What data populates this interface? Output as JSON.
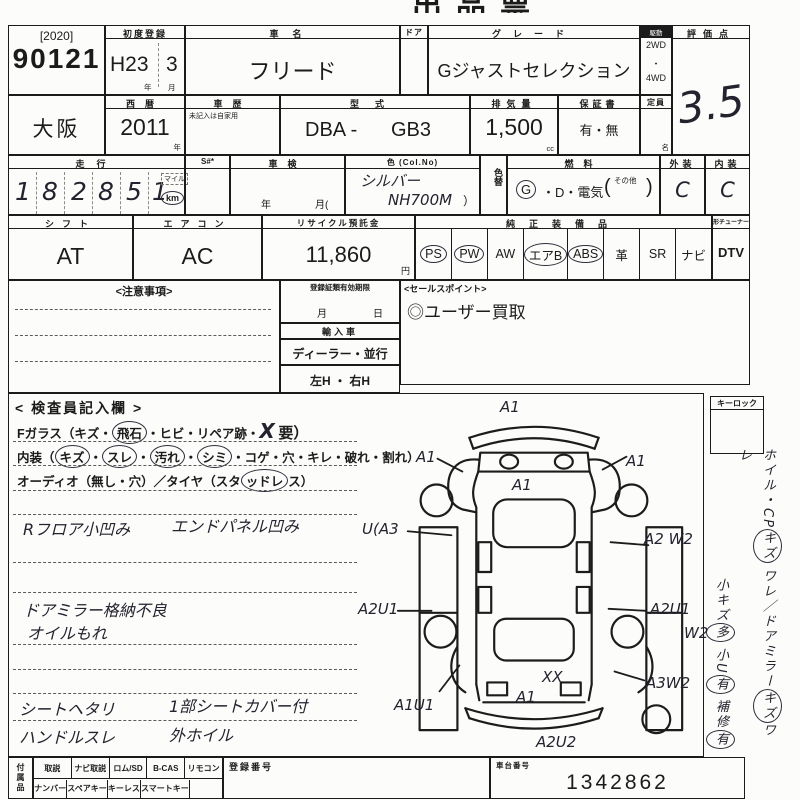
{
  "colors": {
    "ink": "#1b1b1b",
    "paper": "#fcfcfa",
    "handwriting": "#23232f"
  },
  "title_fragment": "出品票",
  "header": {
    "auction_year": "[2020]",
    "auction_no": "90121",
    "first_reg_label": "初度登録",
    "first_reg_era": "H23",
    "first_reg_month": "3",
    "year_char": "年",
    "month_char": "月",
    "car_name_label": "車名",
    "car_name": "フリード",
    "door_label": "ドア",
    "grade_label": "グレード",
    "grade": "Gジャストセレクション",
    "drive_label": "駆動",
    "drive_top": "2WD",
    "drive_mid": "・",
    "drive_bottom": "4WD",
    "score_label": "評価点",
    "score": "3.5"
  },
  "row2": {
    "region": "大阪",
    "seireki_label": "西暦",
    "seireki": "2011",
    "year_char": "年",
    "history_label": "車歴",
    "history_note": "未記入は自家用",
    "model_label": "型式",
    "model_prefix": "DBA -",
    "model": "GB3",
    "disp_label": "排気量",
    "displacement": "1,500",
    "disp_unit": "cc",
    "warranty_label": "保証書",
    "warranty": "有・無",
    "capacity_label": "定員",
    "capacity_unit": "名"
  },
  "row3": {
    "mileage_label": "走行",
    "digits": [
      "1",
      "8",
      "2",
      "8",
      "5",
      "1"
    ],
    "unit_top": "マイル",
    "unit_bottom": "km",
    "s_label": "S#*",
    "shaken_label": "車検",
    "shaken_year": "年",
    "shaken_month": "月(",
    "color_label": "色 (Col.No)",
    "color_hw1": "シルバー",
    "color_hw2": "NH700M",
    "color_close": "）",
    "colorchange_label": "色替",
    "fuel_label": "燃料",
    "fuel_g": "G",
    "fuel_rest": "・D・電気",
    "fuel_open": "(",
    "fuel_other": "その他",
    "fuel_close": ")",
    "exterior_label": "外装",
    "exterior": "C",
    "interior_label": "内装",
    "interior": "C"
  },
  "row4": {
    "shift_label": "シフト",
    "shift": "AT",
    "aircon_label": "エアコン",
    "aircon": "AC",
    "recycle_label": "リサイクル預託金",
    "recycle": "11,860",
    "yen": "円",
    "equip_label": "純正装備品",
    "equipment": [
      {
        "label": "PS",
        "circled": true
      },
      {
        "label": "PW",
        "circled": true
      },
      {
        "label": "AW",
        "circled": false
      },
      {
        "label": "エアB",
        "circled": true
      },
      {
        "label": "ABS",
        "circled": true
      },
      {
        "label": "革",
        "circled": false
      },
      {
        "label": "SR",
        "circled": false
      },
      {
        "label": "ナビ",
        "circled": false
      }
    ],
    "tuner_label": "形チューナー名",
    "dtv": "DTV"
  },
  "notice": {
    "title": "<注意事項>"
  },
  "reg_box": {
    "title": "登録証類有効期限",
    "month_char": "月",
    "day_char": "日",
    "import_label": "輸入車",
    "dealer": "ディーラー・並行",
    "handle": "左H ・ 右H"
  },
  "sales": {
    "title": "<セールスポイント>",
    "point": "◎ユーザー買取"
  },
  "inspector": {
    "title": "< 検査員記入欄 >",
    "glass": [
      {
        "t": "Fガラス（キズ・"
      },
      {
        "t": "飛石",
        "c": true
      },
      {
        "t": "・ヒビ・リペア跡・"
      },
      {
        "t": "X"
      },
      {
        "t": "要）"
      }
    ],
    "interior_line": [
      {
        "t": "内装（"
      },
      {
        "t": "キズ",
        "c": true
      },
      {
        "t": "・"
      },
      {
        "t": "スレ",
        "c": true
      },
      {
        "t": "・"
      },
      {
        "t": "汚れ",
        "c": true
      },
      {
        "t": "・"
      },
      {
        "t": "シミ",
        "c": true
      },
      {
        "t": "・コゲ・穴・キレ・破れ・割れ）"
      }
    ],
    "audio_line": [
      {
        "t": "オーディオ（無し・穴）／タイヤ（スタ"
      },
      {
        "t": "ッドレ",
        "c": true
      },
      {
        "t": "ス）"
      }
    ],
    "notes": [
      {
        "left": "Rフロア小凹み",
        "right": "エンドパネル凹み"
      },
      {
        "left": "ドアミラー格納不良",
        "right": ""
      },
      {
        "left": "オイルもれ",
        "right": ""
      },
      {
        "left": "シートヘタリ",
        "right": "1部シートカバー付"
      },
      {
        "left": "ハンドルスレ",
        "right": "外ホイル"
      }
    ]
  },
  "diagram": {
    "annotations": [
      {
        "text": "A1"
      },
      {
        "text": "A1"
      },
      {
        "text": "A1"
      },
      {
        "text": "A1"
      },
      {
        "text": "U(A3"
      },
      {
        "text": "A2 W2"
      },
      {
        "text": "A2U1"
      },
      {
        "text": "A2U1"
      },
      {
        "text": "W2"
      },
      {
        "text": "A1U1"
      },
      {
        "text": "A3W2"
      },
      {
        "text": "XX"
      },
      {
        "text": "A1"
      },
      {
        "text": "A2U2"
      }
    ]
  },
  "keylock": {
    "label": "キーロック"
  },
  "side_notes": {
    "line1": [
      {
        "t": "ホイル・CP"
      },
      {
        "t": "キズ",
        "c": true
      },
      {
        "t": " ワレ／ドアミラー"
      },
      {
        "t": "キズ",
        "c": true
      },
      {
        "t": "ワレ"
      }
    ],
    "line2": [
      {
        "t": "小キズ"
      },
      {
        "t": "多",
        "c": true
      },
      {
        "t": " 小U"
      },
      {
        "t": "有",
        "c": true
      },
      {
        "t": " 補修"
      },
      {
        "t": "有",
        "c": true
      }
    ]
  },
  "bottom": {
    "accessories_label": "付属品",
    "row1": [
      "取説",
      "ナビ取説",
      "ロム/SD",
      "B-CAS",
      "リモコン"
    ],
    "row2": [
      "ナンバー",
      "スペアキー",
      "キーレス",
      "スマートキー"
    ],
    "regno_label": "登録番号",
    "chassis_label": "車台番号",
    "chassis_no": "1342862"
  }
}
